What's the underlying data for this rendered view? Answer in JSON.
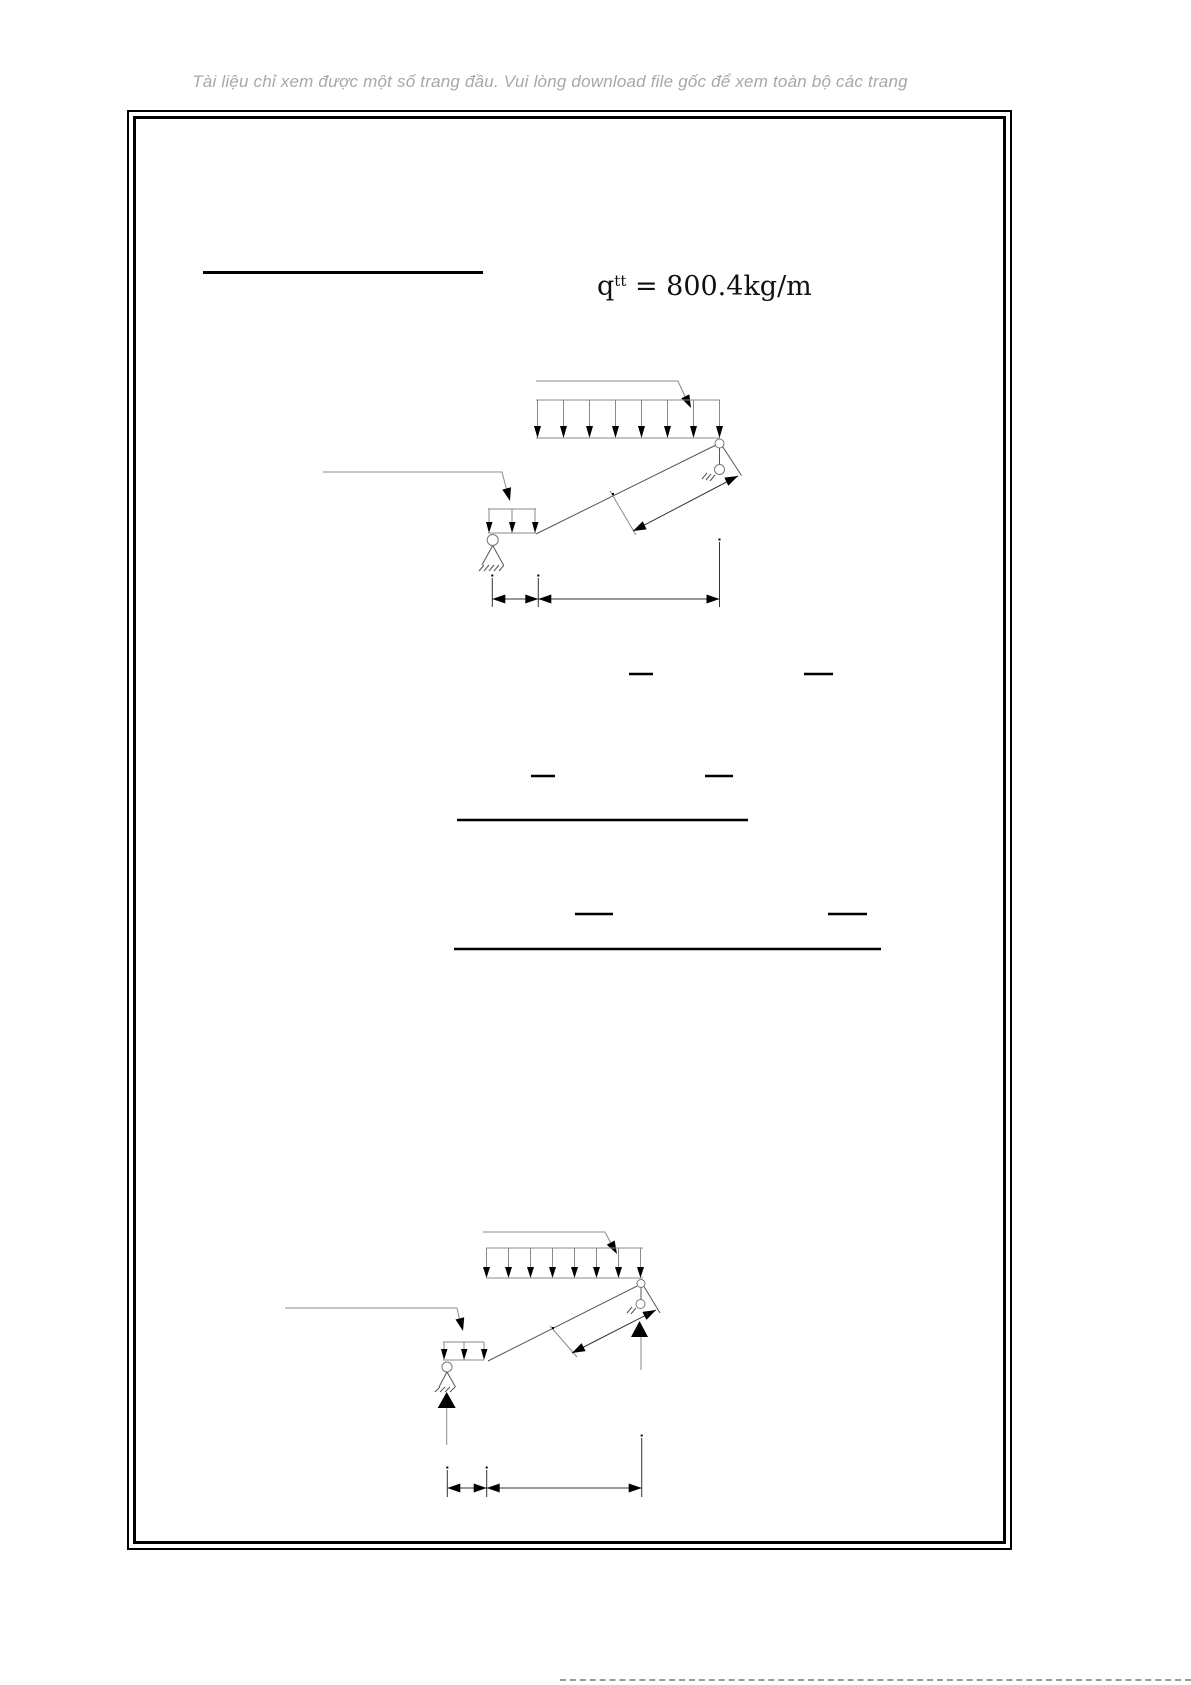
{
  "notice": {
    "text": "Tài liệu chỉ xem được một số trang đầu. Vui lòng download file gốc để xem toàn bộ các trang",
    "color": "#a8a8a8"
  },
  "formula": {
    "base": "q",
    "superscript": "tt",
    "rest": " = 800.4kg/m",
    "full_text": "qtt = 800.4kg/m"
  },
  "colors": {
    "page_background": "#ffffff",
    "frame_border": "#000000",
    "drawing_gray": "#8a8a8a",
    "drawing_dark": "#333333",
    "formula_text": "#111111"
  }
}
